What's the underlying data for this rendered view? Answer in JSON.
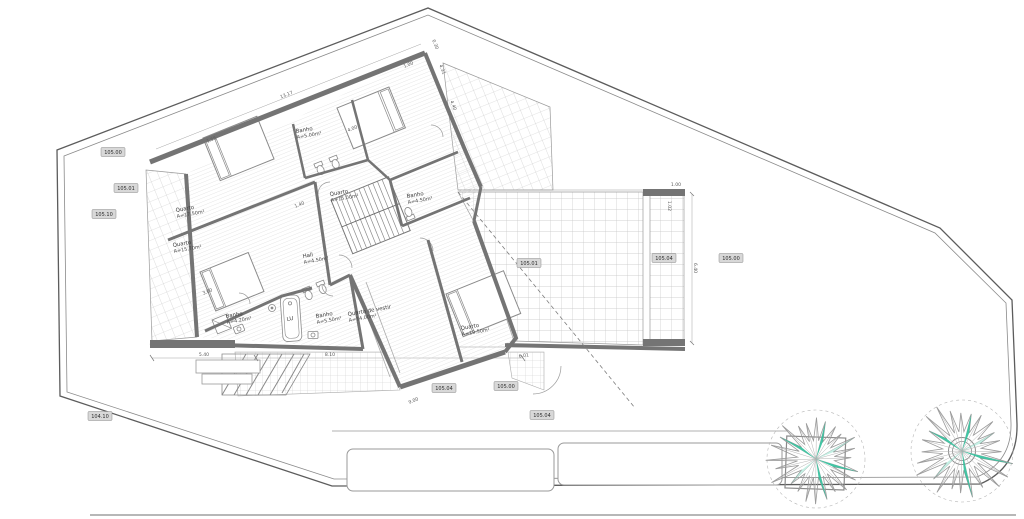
{
  "drawing": {
    "title": "Floor plan – upper level",
    "language": "pt"
  },
  "colors": {
    "wall": "#747474",
    "wall_dark": "#5f5f5f",
    "line": "#8a8a8a",
    "boundary": "#5c5c5c",
    "hatch": "#d2d2d2",
    "grid": "#c6c6c6",
    "tree_accent": "#2fbf9a",
    "tree_accent_light": "#7fdcc4",
    "marker_bg": "#d8d8d8",
    "text": "#3c3c3c"
  },
  "rooms": [
    {
      "name": "Quarto",
      "area": "A=17.50m²",
      "x": 176,
      "y": 212
    },
    {
      "name": "Quarto",
      "area": "A=15.70m²",
      "x": 173,
      "y": 247
    },
    {
      "name": "Banho",
      "area": "A=5.00m²",
      "x": 296,
      "y": 133
    },
    {
      "name": "Quarto",
      "area": "A=15.00m²",
      "x": 330,
      "y": 196
    },
    {
      "name": "Banho",
      "area": "A=4.50m²",
      "x": 407,
      "y": 198
    },
    {
      "name": "Hall",
      "area": "A=4.50m²",
      "x": 303,
      "y": 258
    },
    {
      "name": "Banho",
      "area": "A=4.20m²",
      "x": 226,
      "y": 318
    },
    {
      "name": "LU",
      "area": "",
      "x": 287,
      "y": 321
    },
    {
      "name": "Banho",
      "area": "A=5.50m²",
      "x": 316,
      "y": 318
    },
    {
      "name": "Quarto de vestir",
      "area": "A=14.00m²",
      "x": 348,
      "y": 316
    },
    {
      "name": "Quarto",
      "area": "A=19.50m²",
      "x": 461,
      "y": 330
    }
  ],
  "elevation_markers": [
    {
      "value": "105.00",
      "x": 113,
      "y": 152
    },
    {
      "value": "105.01",
      "x": 126,
      "y": 188
    },
    {
      "value": "105.10",
      "x": 104,
      "y": 214
    },
    {
      "value": "104.10",
      "x": 100,
      "y": 416
    },
    {
      "value": "105.01",
      "x": 529,
      "y": 263
    },
    {
      "value": "105.04",
      "x": 664,
      "y": 258
    },
    {
      "value": "105.00",
      "x": 731,
      "y": 258
    },
    {
      "value": "105.04",
      "x": 444,
      "y": 388
    },
    {
      "value": "105.00",
      "x": 506,
      "y": 386
    },
    {
      "value": "105.04",
      "x": 542,
      "y": 415
    }
  ],
  "dimensions": [
    {
      "v": "13.17",
      "x": 287,
      "y": 96,
      "r": -22
    },
    {
      "v": "5.40",
      "x": 204,
      "y": 356,
      "r": 0
    },
    {
      "v": "8.10",
      "x": 330,
      "y": 356,
      "r": 0
    },
    {
      "v": "6.01",
      "x": 524,
      "y": 357,
      "r": -8
    },
    {
      "v": "0.30",
      "x": 434,
      "y": 45,
      "r": 68
    },
    {
      "v": "1.00",
      "x": 409,
      "y": 66,
      "r": -22
    },
    {
      "v": "4.31",
      "x": 441,
      "y": 70,
      "r": 68
    },
    {
      "v": "4.40",
      "x": 452,
      "y": 106,
      "r": 68
    },
    {
      "v": "1.00",
      "x": 676,
      "y": 186,
      "r": 0
    },
    {
      "v": "1.02",
      "x": 668,
      "y": 206,
      "r": 90
    },
    {
      "v": "6.40",
      "x": 694,
      "y": 268,
      "r": 90
    },
    {
      "v": "4.00",
      "x": 353,
      "y": 130,
      "r": -22
    },
    {
      "v": "1.55",
      "x": 212,
      "y": 141,
      "r": -22
    },
    {
      "v": "1.40",
      "x": 300,
      "y": 206,
      "r": -22
    },
    {
      "v": "3.00",
      "x": 208,
      "y": 293,
      "r": -22
    },
    {
      "v": "9.00",
      "x": 414,
      "y": 402,
      "r": -22
    }
  ],
  "trees": [
    {
      "cx": 816,
      "cy": 459,
      "r": 44,
      "planter": "square"
    },
    {
      "cx": 962,
      "cy": 451,
      "r": 46,
      "planter": "circle"
    }
  ]
}
